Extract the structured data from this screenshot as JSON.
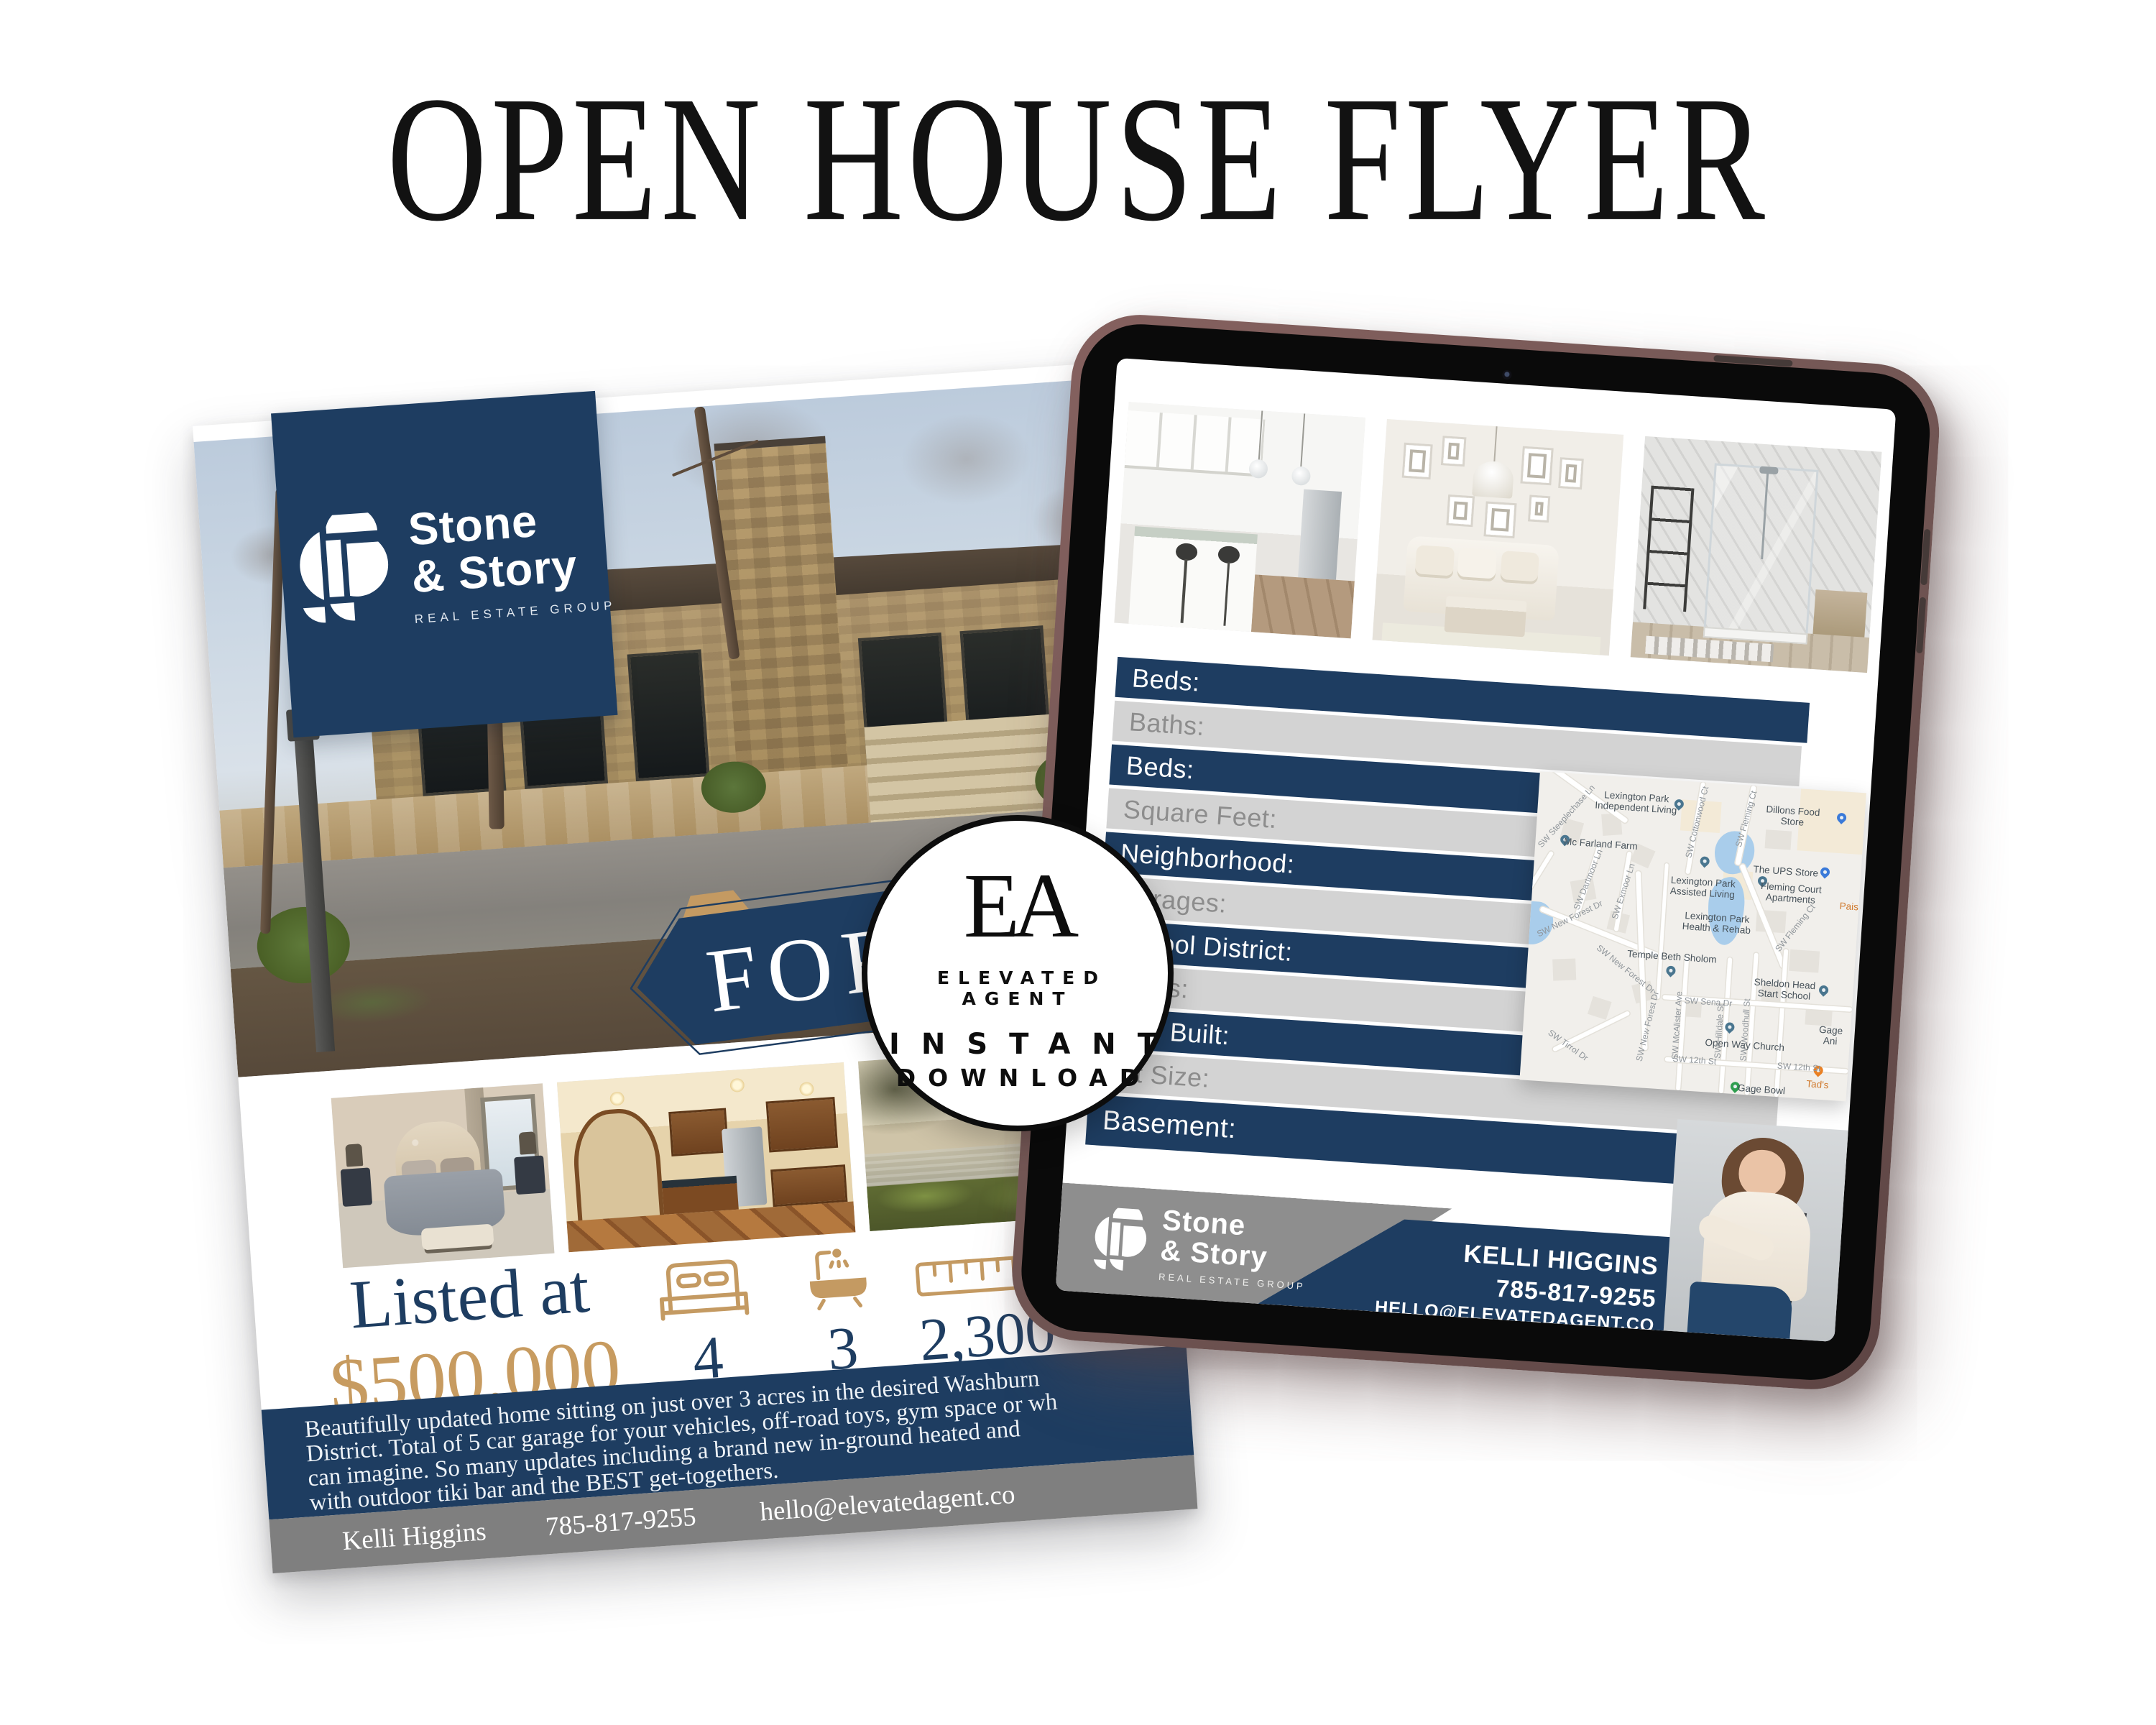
{
  "page": {
    "title": "OPEN HOUSE FLYER"
  },
  "colors": {
    "navy": "#1e3d61",
    "gold": "#c49a62",
    "bar_gray": "#d3d3d3",
    "tablet_frame": "#7d5f5d"
  },
  "brand": {
    "name_top": "Stone",
    "name_bottom": "& Story",
    "tagline": "REAL ESTATE GROUP"
  },
  "badge": {
    "monogram": "EA",
    "brand_line": "ELEVATED AGENT",
    "line2": "INSTANT",
    "line3": "DOWNLOAD"
  },
  "flyer": {
    "ribbon_label": "FOR SALE",
    "listed_label": "Listed at",
    "price": "$500,000",
    "stats": [
      {
        "icon": "bed-icon",
        "value": "4"
      },
      {
        "icon": "bath-icon",
        "value": "3"
      },
      {
        "icon": "ruler-icon",
        "value": "2,300"
      }
    ],
    "description_lines": [
      "Beautifully updated home sitting on just over 3 acres in the desired Washburn",
      "District. Total of 5 car garage for your vehicles, off-road toys, gym space or wh",
      "can imagine. So many updates including a brand new in-ground heated and",
      "with outdoor tiki bar and the BEST get-togethers."
    ],
    "contact": {
      "name": "Kelli Higgins",
      "phone": "785-817-9255",
      "email": "hello@elevatedagent.co"
    }
  },
  "tablet": {
    "fields": [
      {
        "label": "Beds:",
        "tone": "navy"
      },
      {
        "label": "Baths:",
        "tone": "gray"
      },
      {
        "label": "Beds:",
        "tone": "navy"
      },
      {
        "label": "Square Feet:",
        "tone": "gray"
      },
      {
        "label": "Neighborhood:",
        "tone": "navy"
      },
      {
        "label": "Garages:",
        "tone": "gray"
      },
      {
        "label": "School District:",
        "tone": "navy"
      },
      {
        "label": "Taxes:",
        "tone": "gray"
      },
      {
        "label": "Year Built:",
        "tone": "navy"
      },
      {
        "label": "Lot Size:",
        "tone": "gray"
      },
      {
        "label": "Basement:",
        "tone": "navy"
      }
    ],
    "agent": {
      "name": "KELLI HIGGINS",
      "phone": "785-817-9255",
      "email": "HELLO@ELEVATEDAGENT.CO"
    },
    "map": {
      "labels": [
        {
          "text": "Lexington Park\nIndependent Living",
          "x": 30,
          "y": 8,
          "pin": "default",
          "px": 43,
          "py": 9
        },
        {
          "text": "Dillons Food Store",
          "x": 78,
          "y": 9,
          "pin": "blue",
          "px": 93,
          "py": 10
        },
        {
          "text": "Mc Farland Farm",
          "x": 20,
          "y": 22,
          "pin": "default",
          "px": 9,
          "py": 23
        },
        {
          "text": "The UPS Store",
          "x": 77,
          "y": 27,
          "pin": "blue",
          "px": 89,
          "py": 28
        },
        {
          "text": "Lexington Park\nAssisted Living",
          "x": 52,
          "y": 34,
          "pin": "default",
          "px": 52,
          "py": 27
        },
        {
          "text": "Fleming Court\nApartments",
          "x": 79,
          "y": 34,
          "pin": "default",
          "px": 70,
          "py": 32
        },
        {
          "text": "Lexington Park\nHealth & Rehab",
          "x": 57,
          "y": 45,
          "pin": "none",
          "px": 0,
          "py": 0
        },
        {
          "text": "Pais",
          "x": 97,
          "y": 37,
          "pin": "none",
          "px": 0,
          "py": 0,
          "cls": "poi-orange"
        },
        {
          "text": "Temple Beth Sholom",
          "x": 44,
          "y": 57,
          "pin": "default",
          "px": 44,
          "py": 63
        },
        {
          "text": "Sheldon Head\nStart School",
          "x": 79,
          "y": 65,
          "pin": "default",
          "px": 91,
          "py": 66
        },
        {
          "text": "Open Way Church",
          "x": 68,
          "y": 84,
          "pin": "default",
          "px": 63,
          "py": 80
        },
        {
          "text": "Gage Ani",
          "x": 94,
          "y": 79,
          "pin": "none",
          "px": 0,
          "py": 0
        },
        {
          "text": "Tad's",
          "x": 91,
          "y": 95,
          "pin": "orange",
          "px": 91,
          "py": 92,
          "cls": "poi-orange"
        },
        {
          "text": "Gage Bowl",
          "x": 74,
          "y": 98,
          "pin": "green",
          "px": 66,
          "py": 99
        },
        {
          "text": "SW Sena Dr",
          "x": 56,
          "y": 71,
          "pin": "none",
          "px": 0,
          "py": 0,
          "cls": "road-label"
        },
        {
          "text": "SW 12th St",
          "x": 53,
          "y": 90,
          "pin": "none",
          "px": 0,
          "py": 0,
          "cls": "road-label"
        },
        {
          "text": "SW 12th St",
          "x": 85,
          "y": 90,
          "pin": "none",
          "px": 0,
          "py": 0,
          "cls": "road-label"
        },
        {
          "text": "SW Steeplechase Ln",
          "x": 9,
          "y": 14,
          "rot": -52,
          "cls": "road-label"
        },
        {
          "text": "SW Dartmoor Ln",
          "x": 17,
          "y": 34,
          "rot": -72,
          "cls": "road-label"
        },
        {
          "text": "SW Exmoor Ln",
          "x": 28,
          "y": 37,
          "rot": -76,
          "cls": "road-label"
        },
        {
          "text": "SW New Forest Dr",
          "x": 12,
          "y": 47,
          "rot": -30,
          "cls": "road-label"
        },
        {
          "text": "SW New Forest Dr",
          "x": 30,
          "y": 62,
          "rot": 35,
          "cls": "road-label"
        },
        {
          "text": "SW New Forest Dr",
          "x": 38,
          "y": 80,
          "rot": -80,
          "cls": "road-label"
        },
        {
          "text": "SW Cottonwood Ct",
          "x": 49,
          "y": 13,
          "rot": -80,
          "cls": "road-label"
        },
        {
          "text": "SW Fleming Ct",
          "x": 64,
          "y": 11,
          "rot": -78,
          "cls": "road-label"
        },
        {
          "text": "SW Fleming Ct",
          "x": 81,
          "y": 45,
          "rot": -55,
          "cls": "road-label"
        },
        {
          "text": "SW McAlister Ave",
          "x": 47,
          "y": 79,
          "rot": -90,
          "cls": "road-label"
        },
        {
          "text": "SW Hilldale St",
          "x": 60,
          "y": 80,
          "rot": -90,
          "cls": "road-label"
        },
        {
          "text": "SW Woodhull St",
          "x": 68,
          "y": 79,
          "rot": -90,
          "cls": "road-label"
        },
        {
          "text": "SW Tirrol Dr",
          "x": 14,
          "y": 88,
          "rot": 32,
          "cls": "road-label"
        }
      ]
    }
  }
}
